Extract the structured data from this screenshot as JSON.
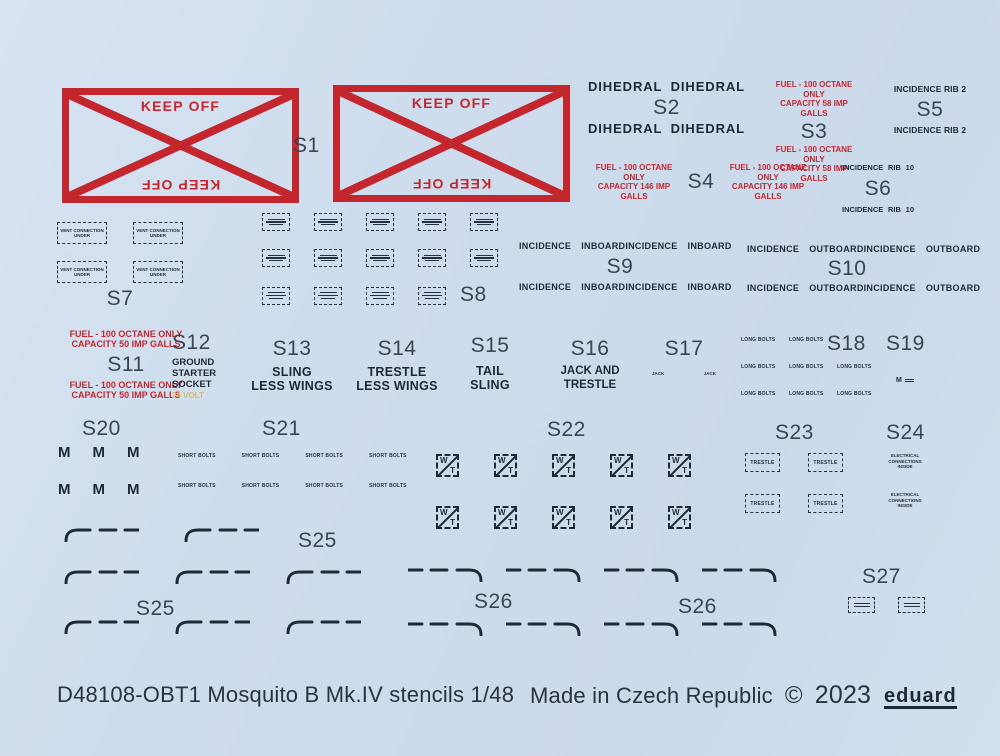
{
  "palette": {
    "background": "#cedded",
    "red": "#c4262e",
    "ink": "#1e2936",
    "label": "#3a4553",
    "gold": "#d8b96e"
  },
  "groups": {
    "s1": {
      "label": "S1",
      "keep_off": "KEEP OFF"
    },
    "s2": {
      "label": "S2",
      "text": "DIHEDRAL"
    },
    "s3": {
      "label": "S3",
      "line1": "FUEL - 100 OCTANE ONLY",
      "line2": "CAPACITY 58 IMP GALLS"
    },
    "s4": {
      "label": "S4",
      "line1": "FUEL - 100 OCTANE ONLY",
      "line2": "CAPACITY 146 IMP GALLS"
    },
    "s5": {
      "label": "S5",
      "text": "INCIDENCE RIB 2"
    },
    "s6": {
      "label": "S6",
      "word1": "INCIDENCE",
      "word2": "RIB",
      "word3": "10"
    },
    "s7": {
      "label": "S7",
      "line1": "VENT CONNECTION",
      "line2": "UNDER"
    },
    "s8": {
      "label": "S8"
    },
    "s9": {
      "label": "S9",
      "word1": "INCIDENCE",
      "word2": "INBOARD"
    },
    "s10": {
      "label": "S10",
      "word1": "INCIDENCE",
      "word2": "OUTBOARD"
    },
    "s11": {
      "label": "S11",
      "line1": "FUEL - 100 OCTANE ONLY",
      "line2": "CAPACITY 50 IMP GALLS"
    },
    "s12": {
      "label": "S12",
      "line1": "GROUND",
      "line2": "STARTER",
      "line3": "SOCKET",
      "line4": "24 VOLT"
    },
    "s13": {
      "label": "S13",
      "line1": "SLING",
      "line2": "LESS WINGS"
    },
    "s14": {
      "label": "S14",
      "line1": "TRESTLE",
      "line2": "LESS WINGS"
    },
    "s15": {
      "label": "S15",
      "line1": "TAIL",
      "line2": "SLING"
    },
    "s16": {
      "label": "S16",
      "line1": "JACK AND",
      "line2": "TRESTLE"
    },
    "s17": {
      "label": "S17",
      "text": "JACK"
    },
    "s18": {
      "label": "S18",
      "text": "LONG BOLTS"
    },
    "s19": {
      "label": "S19",
      "text": "M"
    },
    "s20": {
      "label": "S20",
      "text": "M"
    },
    "s21": {
      "label": "S21",
      "text": "SHORT BOLTS"
    },
    "s22": {
      "label": "S22",
      "w": "W",
      "t": "T"
    },
    "s23": {
      "label": "S23",
      "text": "TRESTLE"
    },
    "s24": {
      "label": "S24",
      "line1": "ELECTRICAL",
      "line2": "CONNECTIONS",
      "line3": "INSIDE"
    },
    "s25": {
      "label": "S25"
    },
    "s26": {
      "label": "S26"
    },
    "s27": {
      "label": "S27"
    }
  },
  "footer": {
    "product": "D48108-OBT1 Mosquito B Mk.IV stencils 1/48",
    "made_in": "Made in Czech Republic",
    "copyright": "©",
    "year": "2023",
    "brand": "eduard"
  }
}
